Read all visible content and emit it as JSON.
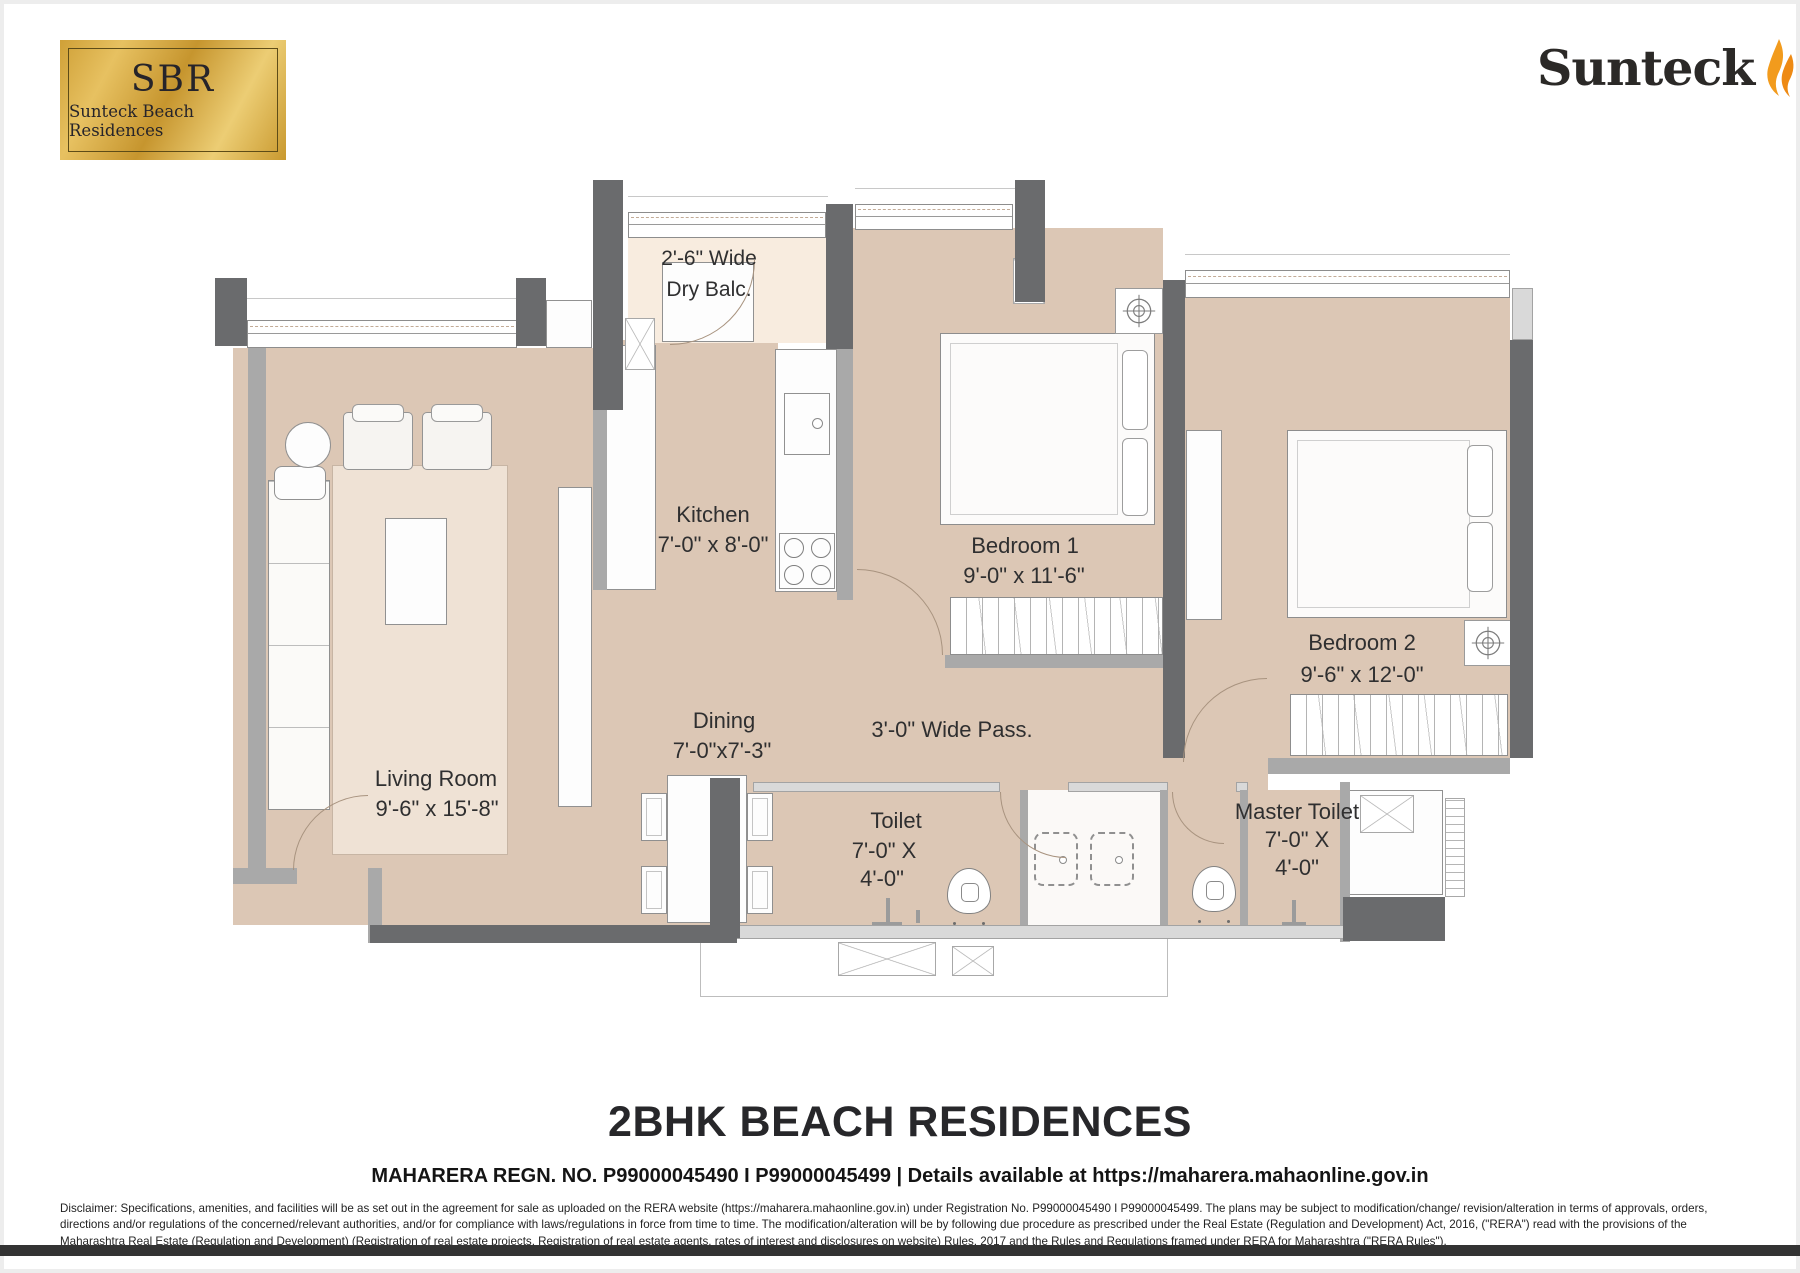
{
  "brand": {
    "badge_abbr": "SBR",
    "badge_name": "Sunteck Beach Residences",
    "logo_text": "Sunteck"
  },
  "plan": {
    "rooms": {
      "dry_balc": {
        "line1": "2'-6\" Wide",
        "line2": "Dry Balc."
      },
      "kitchen": {
        "name": "Kitchen",
        "size": "7'-0\" x 8'-0\""
      },
      "bedroom1": {
        "name": "Bedroom 1",
        "size": "9'-0\" x 11'-6\""
      },
      "bedroom2": {
        "name": "Bedroom 2",
        "size": "9'-6\" x 12'-0\""
      },
      "living": {
        "name": "Living Room",
        "size": "9'-6\" x 15'-8\""
      },
      "dining": {
        "name": "Dining",
        "size": "7'-0\"x7'-3\""
      },
      "passage": {
        "name": "3'-0\" Wide Pass."
      },
      "toilet": {
        "name": "Toilet",
        "size1": "7'-0\" X",
        "size2": "4'-0\""
      },
      "master_toilet": {
        "name": "Master Toilet",
        "size1": "7'-0\" X",
        "size2": "4'-0\""
      }
    }
  },
  "footer": {
    "title": "2BHK BEACH RESIDENCES",
    "rera": "MAHARERA REGN. NO. P99000045490 I P99000045499 | Details available at https://maharera.mahaonline.gov.in",
    "disclaimer": "Disclaimer: Specifications, amenities, and facilities will be as set out in the agreement for sale as uploaded on the RERA website (https://maharera.mahaonline.gov.in) under Registration No. P99000045490 I P99000045499. The plans may be subject to modification/change/ revision/alteration in terms of approvals, orders, directions and/or regulations of the concerned/relevant authorities, and/or for compliance with laws/regulations in force from time to time. The modification/alteration will be by following due procedure as prescribed under the Real Estate (Regulation and Development) Act, 2016, (\"RERA\") read with the provisions of the Maharashtra Real Estate (Regulation and Development) (Registration of real estate projects, Registration of real estate agents, rates of interest and disclosures on website) Rules, 2017 and the Rules and Regulations framed under RERA for Maharashtra (\"RERA Rules\")."
  },
  "colors": {
    "floor": "#dcc7b5",
    "balcony_floor": "#f8ecdf",
    "wall_dark": "#6a6b6d",
    "wall_light": "#a9a9a9",
    "gold": "#d8a942",
    "flame": "#f0921e"
  }
}
